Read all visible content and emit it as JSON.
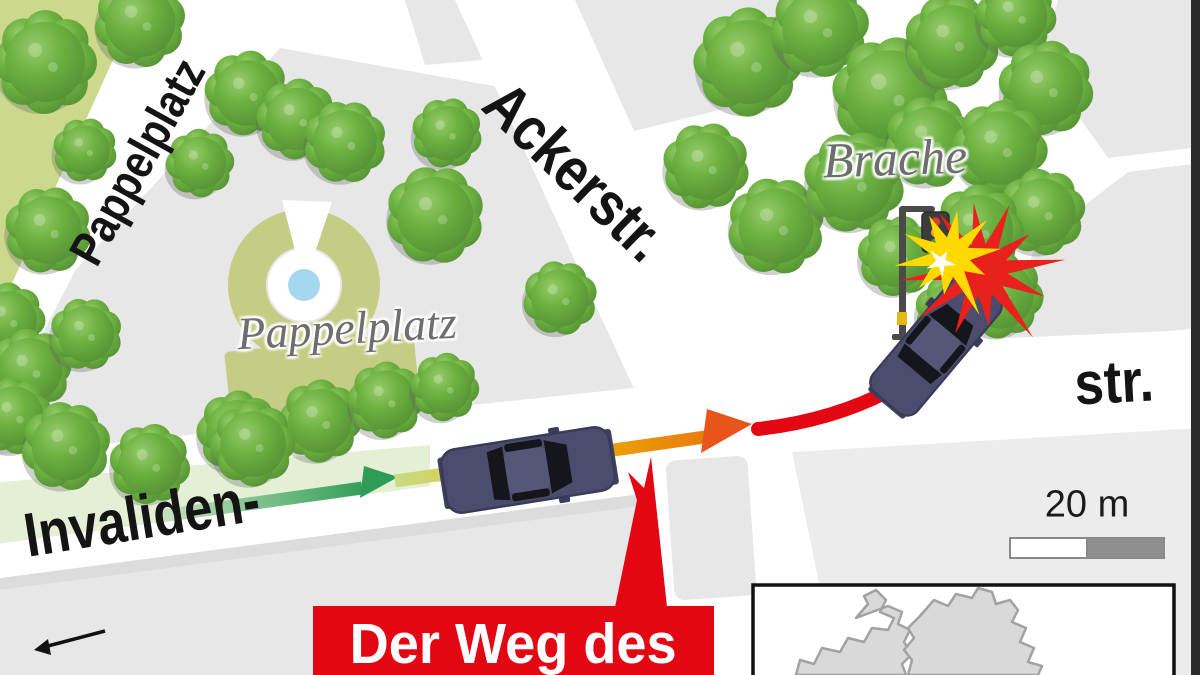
{
  "streets": {
    "invaliden": "Invaliden-",
    "str_suffix": "str.",
    "acker": "Ackerstr.",
    "pappelplatz_street": "Pappelplatz"
  },
  "places": {
    "park": "Pappelplatz",
    "vacant_lot": "Brache"
  },
  "scale_bar": {
    "label": "20 m"
  },
  "callout": {
    "text": "Der Weg des"
  },
  "colors": {
    "accent_red": "#e30613",
    "park_green": "#ccd98d",
    "tree_green": "#6ab042",
    "plaza_olive": "#c5cc83",
    "pond_blue": "#a6d7f0",
    "car_navy": "#4b4c6e",
    "block_gray": "#e7e7e7",
    "road_white": "#ffffff",
    "path_green": "#2f9e57",
    "path_orange": "#f0a500",
    "crash_yellow": "#ffd900",
    "label_gray": "#6e6e6e"
  }
}
